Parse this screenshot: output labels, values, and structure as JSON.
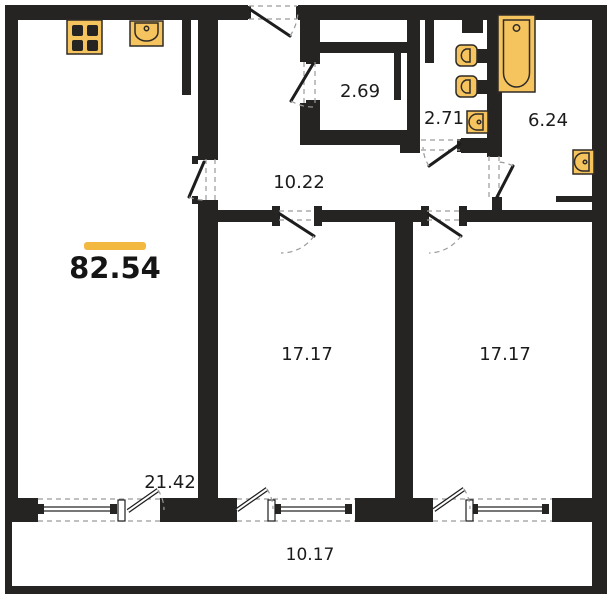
{
  "plan": {
    "type": "apartment-floor-plan",
    "total_area": {
      "value": "82.54"
    },
    "rooms": [
      {
        "id": "storage",
        "area": "2.69"
      },
      {
        "id": "wc",
        "area": "2.71"
      },
      {
        "id": "bathroom",
        "area": "6.24"
      },
      {
        "id": "hallway",
        "area": "10.22"
      },
      {
        "id": "living-kitchen",
        "area": "21.42"
      },
      {
        "id": "bedroom-left",
        "area": "17.17"
      },
      {
        "id": "bedroom-right",
        "area": "17.17"
      },
      {
        "id": "balcony",
        "area": "10.17"
      }
    ],
    "colors": {
      "wall": "#262422",
      "fixture_fill": "#F6C45E",
      "accent_bar": "#F3B83F",
      "dash": "#9a9a9a",
      "text": "#1b1b1b"
    },
    "icons": [
      "stove-icon",
      "kitchen-sink-icon",
      "toilet-icon",
      "toilet-icon",
      "wc-sink-icon",
      "bathtub-icon",
      "bathroom-sink-icon"
    ]
  }
}
